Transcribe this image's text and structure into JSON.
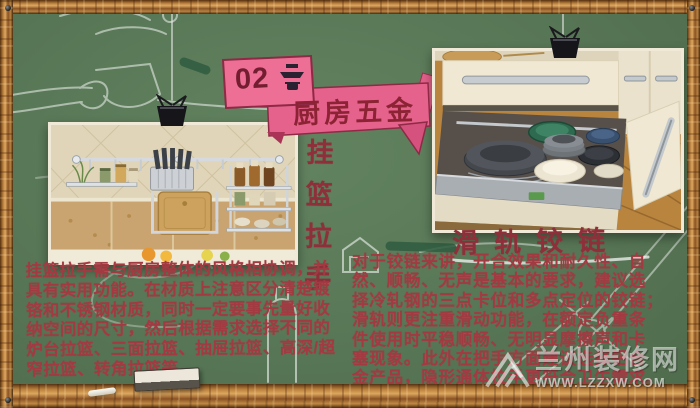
{
  "banner": {
    "number": "02",
    "icon": "range-hood-icon",
    "title": "厨房五金"
  },
  "left_section": {
    "vertical_title": "挂篮拉手",
    "photo_alt": "kitchen wall rail with hanging baskets, knife rack and cutting board",
    "paragraph_lines": [
      "挂篮拉手需与厨房整体的风格相协调，并",
      "具有实用功能。在材质上注意区分清楚镀",
      "铬和不锈钢材质，同时一定要事先量好收",
      "纳空间的尺寸，然后根据需求选择不同的",
      "炉台拉篮、三面拉篮、抽屉拉篮、高深/超",
      "窄拉篮、转角拉篮等。"
    ]
  },
  "right_section": {
    "title": "滑轨铰链",
    "photo_alt": "open kitchen drawer on slide rails filled with plates and bowls",
    "paragraph_lines": [
      "对于铰链来讲，开合效果和耐久性、自",
      "然、顺畅、无声是基本的要求，建议选",
      "择冷轧钢的三点卡位和多点定位的铰链；",
      "滑轨则更注重滑动功能，在额定负重条",
      "件使用时平稳顺畅、无明显摩擦声和卡",
      "塞现象。此外在把手方面建议选择铝合",
      "金产品，隐形通体拉手更符合卫生需求。"
    ]
  },
  "watermark": {
    "site_name": "兰州装修网",
    "site_url": "WWW.LZZXW.COM"
  },
  "colors": {
    "board_green": "#587756",
    "accent_pink": "#ee6f96",
    "ribbon_pink": "#e5628c",
    "text_red": "#a23a42",
    "title_red": "#8e2f3a",
    "wood_brown": "#b97f3d"
  }
}
